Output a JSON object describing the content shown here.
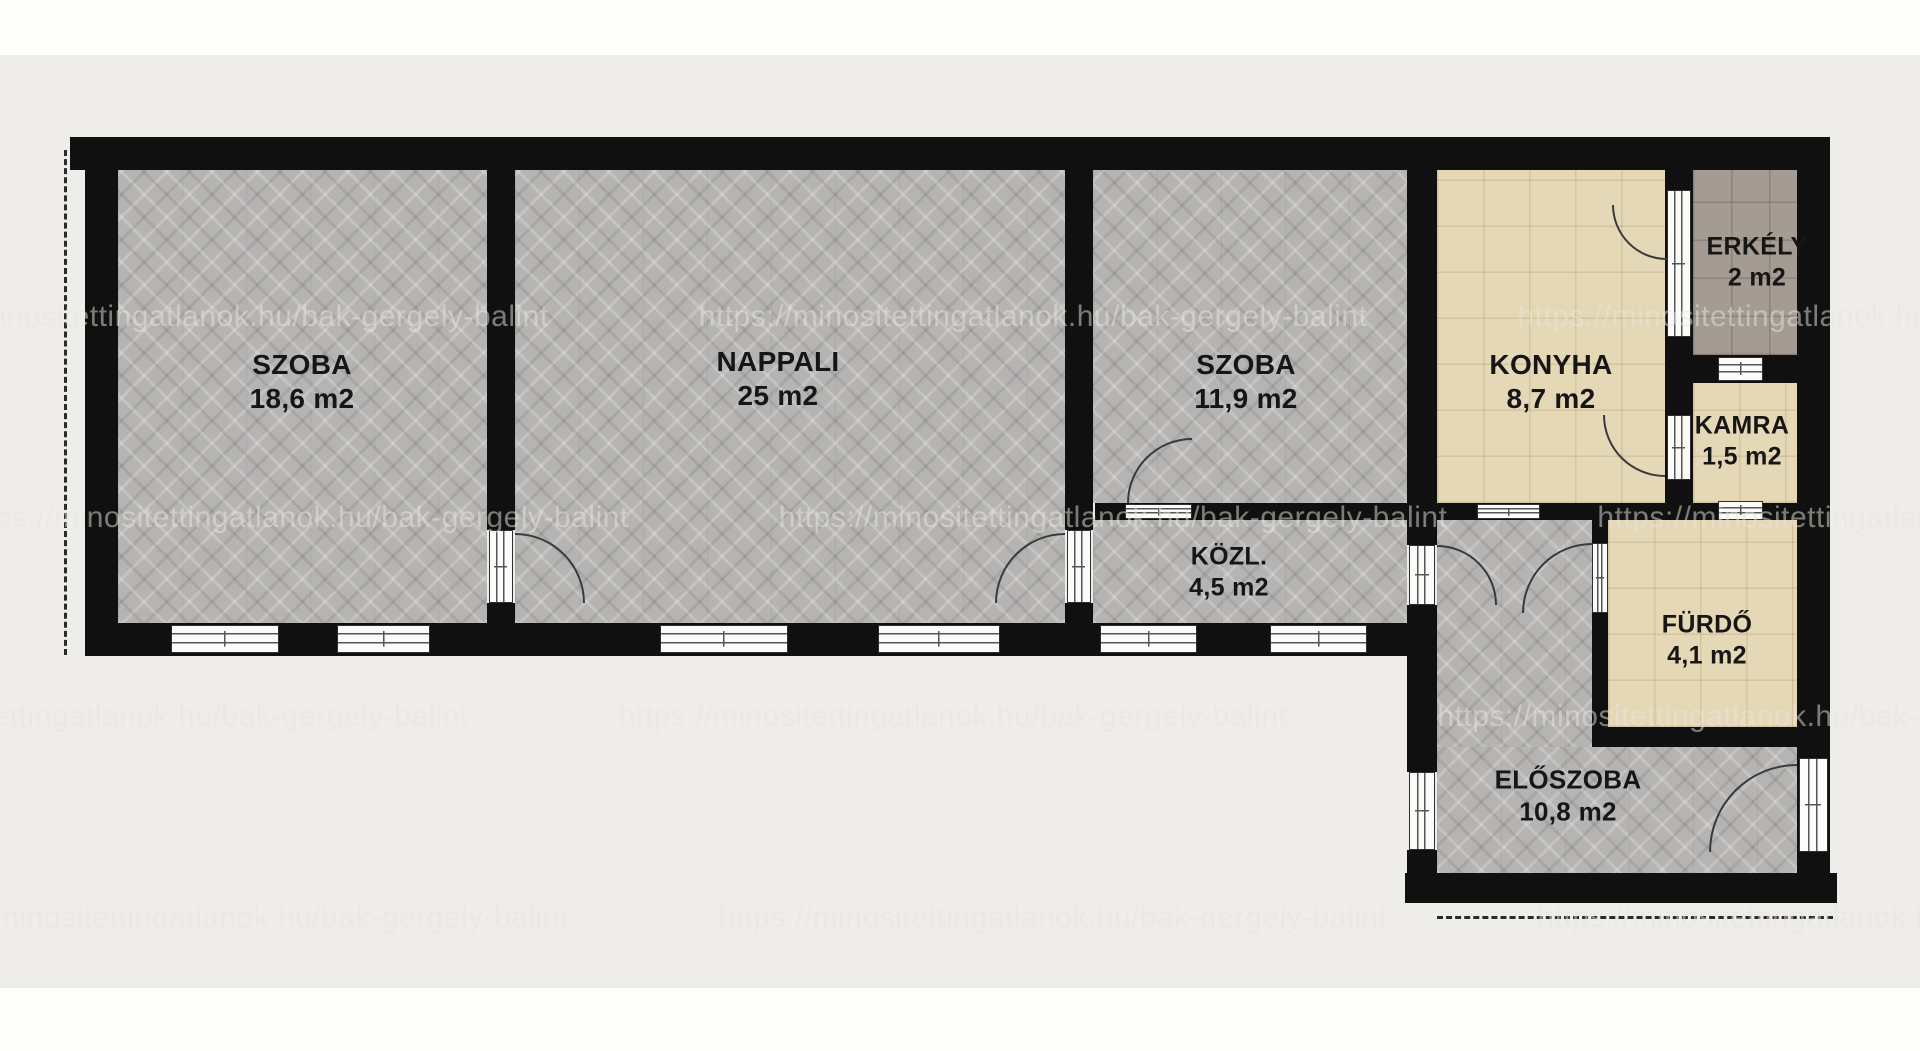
{
  "plan": {
    "title": "Apartment floor plan",
    "units": "m2"
  },
  "rooms": {
    "szoba1": {
      "name": "SZOBA",
      "area": "18,6 m2"
    },
    "nappali": {
      "name": "NAPPALI",
      "area": "25 m2"
    },
    "szoba2": {
      "name": "SZOBA",
      "area": "11,9 m2"
    },
    "konyha": {
      "name": "KONYHA",
      "area": "8,7 m2"
    },
    "erkely": {
      "name": "ERKÉLY",
      "area": "2 m2"
    },
    "kamra": {
      "name": "KAMRA",
      "area": "1,5 m2"
    },
    "kozl": {
      "name": "KÖZL.",
      "area": "4,5 m2"
    },
    "furdo": {
      "name": "FÜRDŐ",
      "area": "4,1 m2"
    },
    "eloszoba": {
      "name": "ELŐSZOBA",
      "area": "10,8 m2"
    }
  },
  "watermark": {
    "text": "https://minositettingatlanok.hu/bak-gergely-balint"
  },
  "colors": {
    "page": "#fdfdfb",
    "background": "#efede9",
    "wall": "#101010",
    "parquet": "#b6b4b2",
    "tile_beige": "#e5d8b6",
    "tile_balcony": "#a49b92",
    "label": "#161616"
  }
}
